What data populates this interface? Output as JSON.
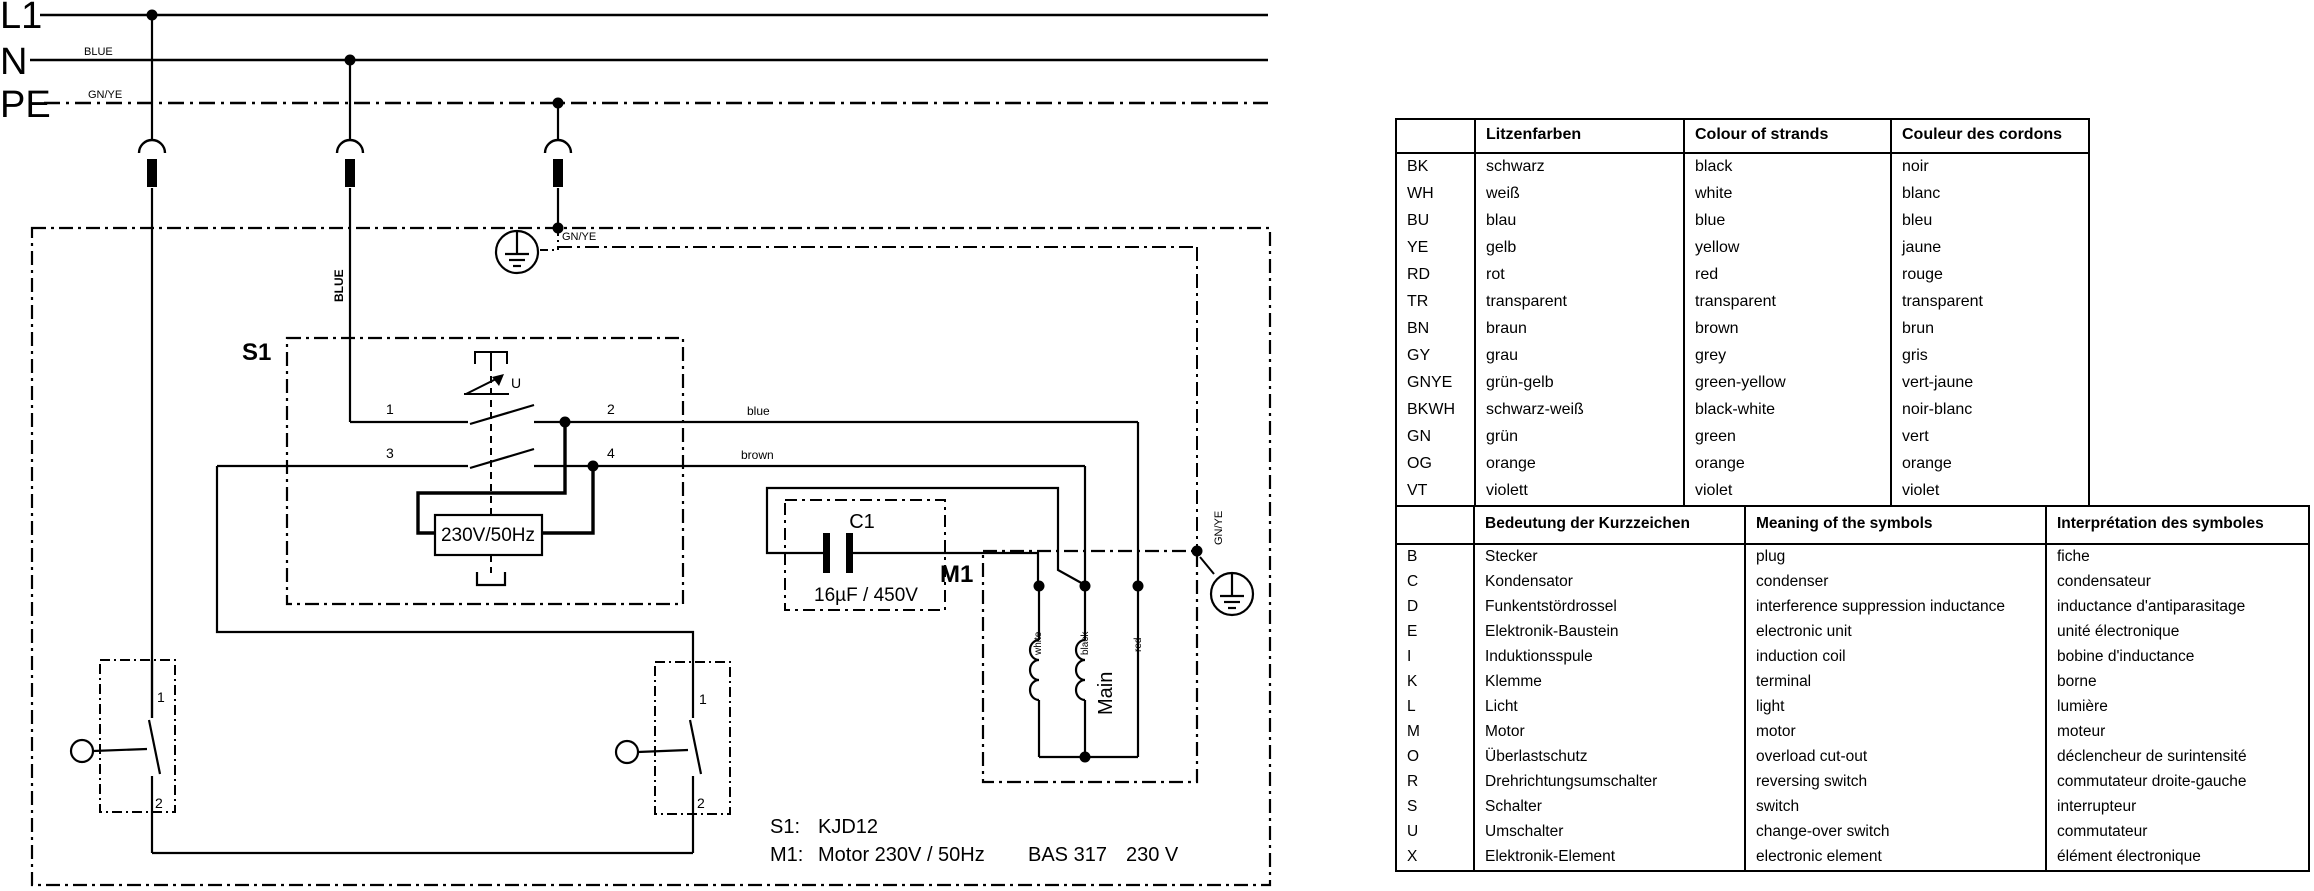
{
  "diagram": {
    "rails": {
      "l1": "L1",
      "n": "N",
      "pe": "PE",
      "blue_tag": "BLUE",
      "gnye_tag": "GN/YE"
    },
    "wires": {
      "blue": "blue",
      "brown": "brown",
      "blue_vertical": "BLUE",
      "gnye_top": "GN/YE",
      "gnye_right": "GN/YE"
    },
    "s1": {
      "title": "S1",
      "u": "U",
      "t1": "1",
      "t2": "2",
      "t3": "3",
      "t4": "4",
      "coil": "230V/50Hz"
    },
    "c1": {
      "title": "C1",
      "value": "16µF / 450V"
    },
    "m1": {
      "title": "M1",
      "white": "white",
      "black": "black",
      "red": "red",
      "main": "Main"
    },
    "interlock": {
      "t1": "1",
      "t2": "2"
    },
    "notes": {
      "s1_key": "S1:",
      "s1_val": "KJD12",
      "m1_key": "M1:",
      "m1_val": "Motor 230V / 50Hz",
      "model_name": "BAS 317",
      "model_voltage": "230 V"
    }
  },
  "color_table": {
    "headers": [
      "",
      "Litzenfarben",
      "Colour of strands",
      "Couleur des cordons"
    ],
    "rows": [
      [
        "BK",
        "schwarz",
        "black",
        "noir"
      ],
      [
        "WH",
        "weiß",
        "white",
        "blanc"
      ],
      [
        "BU",
        "blau",
        "blue",
        "bleu"
      ],
      [
        "YE",
        "gelb",
        "yellow",
        "jaune"
      ],
      [
        "RD",
        "rot",
        "red",
        "rouge"
      ],
      [
        "TR",
        "transparent",
        "transparent",
        "transparent"
      ],
      [
        "BN",
        "braun",
        "brown",
        "brun"
      ],
      [
        "GY",
        "grau",
        "grey",
        "gris"
      ],
      [
        "GNYE",
        "grün-gelb",
        "green-yellow",
        "vert-jaune"
      ],
      [
        "BKWH",
        "schwarz-weiß",
        "black-white",
        "noir-blanc"
      ],
      [
        "GN",
        "grün",
        "green",
        "vert"
      ],
      [
        "OG",
        "orange",
        "orange",
        "orange"
      ],
      [
        "VT",
        "violett",
        "violet",
        "violet"
      ],
      [
        "TQ",
        "türkis",
        "turquoise",
        "turquoise"
      ]
    ]
  },
  "symbol_table": {
    "headers": [
      "",
      "Bedeutung der Kurzzeichen",
      "Meaning of the symbols",
      "Interprétation des symboles"
    ],
    "rows": [
      [
        "B",
        "Stecker",
        "plug",
        "fiche"
      ],
      [
        "C",
        "Kondensator",
        "condenser",
        "condensateur"
      ],
      [
        "D",
        "Funkentstördrossel",
        "interference suppression inductance",
        "inductance d'antiparasitage"
      ],
      [
        "E",
        "Elektronik-Baustein",
        "electronic unit",
        "unité électronique"
      ],
      [
        "I",
        "Induktionsspule",
        "induction coil",
        "bobine d'inductance"
      ],
      [
        "K",
        "Klemme",
        "terminal",
        "borne"
      ],
      [
        "L",
        "Licht",
        "light",
        "lumière"
      ],
      [
        "M",
        "Motor",
        "motor",
        "moteur"
      ],
      [
        "O",
        "Überlastschutz",
        "overload cut-out",
        "déclencheur de surintensité"
      ],
      [
        "R",
        "Drehrichtungsumschalter",
        "reversing switch",
        "commutateur droite-gauche"
      ],
      [
        "S",
        "Schalter",
        "switch",
        "interrupteur"
      ],
      [
        "U",
        "Umschalter",
        "change-over switch",
        "commutateur"
      ],
      [
        "X",
        "Elektronik-Element",
        "electronic element",
        "élément électronique"
      ]
    ]
  }
}
